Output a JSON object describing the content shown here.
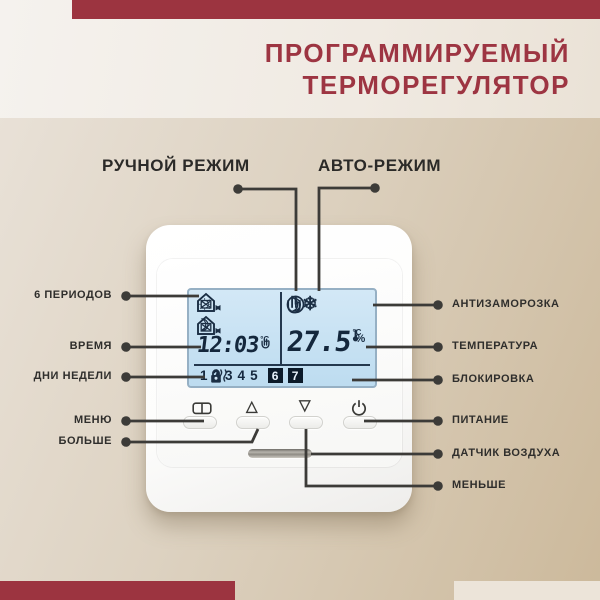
{
  "header": {
    "title_line1": "ПРОГРАММИРУЕМЫЙ",
    "title_line2": "ТЕРМОРЕГУЛЯТОР"
  },
  "modes": {
    "manual_label": "РУЧНОЙ РЕЖИМ",
    "auto_label": "АВТО-РЕЖИМ"
  },
  "callouts": {
    "left": [
      "6 ПЕРИОДОВ",
      "ВРЕМЯ",
      "ДНИ НЕДЕЛИ",
      "МЕНЮ",
      "БОЛЬШЕ"
    ],
    "right": [
      "АНТИЗАМОРОЗКА",
      "ТЕМПЕРАТУРА",
      "БЛОКИРОВКА",
      "ПИТАНИЕ",
      "ДАТЧИК ВОЗДУХА",
      "МЕНЬШЕ"
    ]
  },
  "device": {
    "display": {
      "time": "12:03",
      "time_unit": "°C",
      "temperature": "27.5",
      "temperature_unit": "°C",
      "temperature_sub_unit": "%",
      "days": [
        "1",
        "2",
        "3",
        "4",
        "5",
        "6",
        "7"
      ],
      "active_days": "6,7",
      "left_icons": [
        "sun",
        "house-leave",
        "house-work-return",
        "moon",
        "house-return",
        "house-work-leave"
      ],
      "right_icons": [
        "hand-manual",
        "clock-auto",
        "moon-night",
        "snowflake-antifreeze"
      ],
      "status_icons": [
        "heating-waves",
        "lock"
      ]
    },
    "buttons": [
      "menu-book",
      "up",
      "down",
      "power"
    ]
  },
  "icons": {
    "sun": "☼",
    "moon": "☽",
    "snowflake": "❄",
    "triangle_up": "△",
    "triangle_down": "▽"
  },
  "colors": {
    "accent_red": "#9c3440",
    "title_red": "#9d3542",
    "lcd_blue": "#c5e0f2",
    "background_tan": "#ccb99b",
    "cream_bar": "#ece4d9",
    "line_dark": "#3c3b38"
  }
}
